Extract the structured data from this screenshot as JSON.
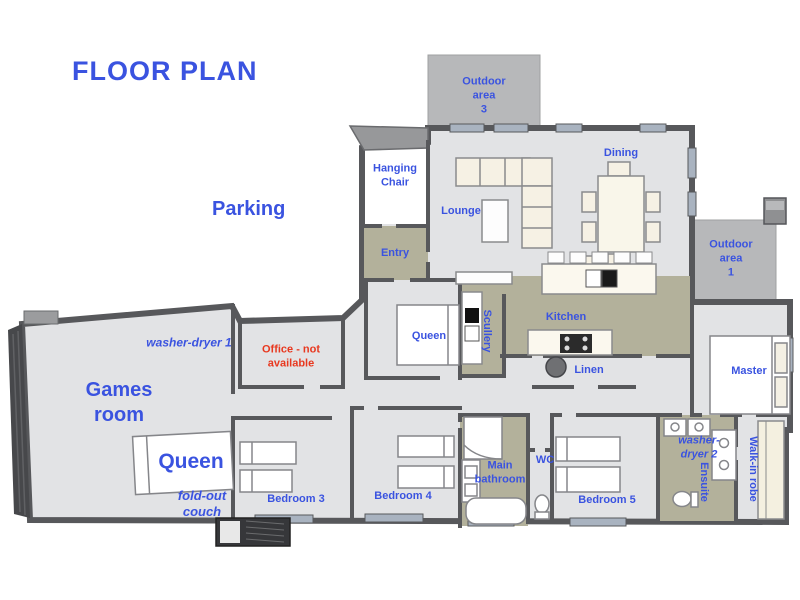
{
  "title": "FLOOR PLAN",
  "colors": {
    "label_blue": "#3a53e0",
    "label_red": "#e8381f",
    "floor_gray": "#e2e3e5",
    "wet_area_olive": "#b3b19b",
    "wall_dark": "#57585b",
    "outdoor_gray": "#b7b8ba",
    "furniture_cream": "#f6f1e4",
    "window_blue_gray": "#a9b3c0"
  },
  "areas": {
    "parking": {
      "label": "Parking"
    },
    "outdoor_area_3": {
      "lines": [
        "Outdoor",
        "area",
        "3"
      ]
    },
    "outdoor_area_1": {
      "lines": [
        "Outdoor",
        "area",
        "1"
      ]
    },
    "hanging_chair": {
      "lines": [
        "Hanging",
        "Chair"
      ]
    },
    "lounge": {
      "label": "Lounge"
    },
    "dining": {
      "label": "Dining"
    },
    "entry": {
      "label": "Entry"
    },
    "kitchen": {
      "label": "Kitchen"
    },
    "scullery": {
      "label": "Scullery"
    },
    "linen": {
      "label": "Linen"
    },
    "queen_bedroom": {
      "label": "Queen"
    },
    "washer_dryer_1": {
      "label": "washer-dryer 1"
    },
    "office": {
      "lines": [
        "Office - not",
        "available"
      ]
    },
    "games_room": {
      "lines": [
        "Games",
        "room"
      ]
    },
    "queen_bed_games": {
      "label": "Queen"
    },
    "fold_out_couch": {
      "lines": [
        "fold-out",
        "couch"
      ]
    },
    "bedroom_3": {
      "label": "Bedroom 3"
    },
    "bedroom_4": {
      "label": "Bedroom 4"
    },
    "bedroom_5": {
      "label": "Bedroom 5"
    },
    "main_bathroom": {
      "lines": [
        "Main",
        "bathroom"
      ]
    },
    "wc": {
      "label": "WC"
    },
    "washer_dryer_2": {
      "lines": [
        "washer-",
        "dryer 2"
      ]
    },
    "ensuite": {
      "label": "Ensuite"
    },
    "walk_in_robe": {
      "label": "Walk-in robe"
    },
    "master": {
      "label": "Master"
    }
  }
}
